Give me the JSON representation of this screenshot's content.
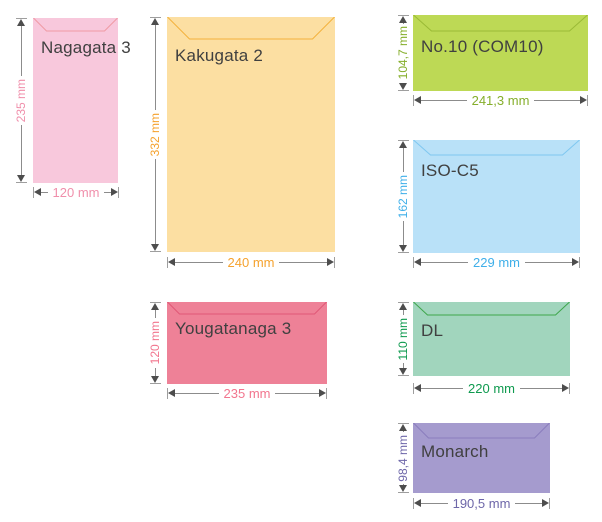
{
  "page": {
    "background": "#ffffff",
    "name_color": "#404040"
  },
  "arrow": {
    "line_color": "#8c8c8c",
    "head_color": "#4d4d4d",
    "tick_color": "#9e9e9e"
  },
  "envelopes": [
    {
      "name": "Nagagata 3",
      "height_label": "235 mm",
      "width_label": "120 mm",
      "fill": "#f8c8dc",
      "flap_color": "#f09aa4",
      "dim_color": "#f08fab"
    },
    {
      "name": "Kakugata 2",
      "height_label": "332 mm",
      "width_label": "240 mm",
      "fill": "#fcdfa2",
      "flap_color": "#f3b23c",
      "dim_color": "#f5a22e"
    },
    {
      "name": "Yougatanaga 3",
      "height_label": "120 mm",
      "width_label": "235 mm",
      "fill": "#ee8197",
      "flap_color": "#e05877",
      "dim_color": "#f2758e"
    },
    {
      "name": "No.10 (COM10)",
      "height_label": "104,7 mm",
      "width_label": "241,3 mm",
      "fill": "#bdd955",
      "flap_color": "#9aba36",
      "dim_color": "#85ae2b"
    },
    {
      "name": "ISO-C5",
      "height_label": "162 mm",
      "width_label": "229 mm",
      "fill": "#b9e1f8",
      "flap_color": "#7fc7f0",
      "dim_color": "#3fafe9"
    },
    {
      "name": "DL",
      "height_label": "110 mm",
      "width_label": "220 mm",
      "fill": "#a1d5bd",
      "flap_color": "#3ea64b",
      "dim_color": "#0f9a4f"
    },
    {
      "name": "Monarch",
      "height_label": "98,4 mm",
      "width_label": "190,5 mm",
      "fill": "#a59bce",
      "flap_color": "#8a7dbd",
      "dim_color": "#6e67a9"
    }
  ]
}
